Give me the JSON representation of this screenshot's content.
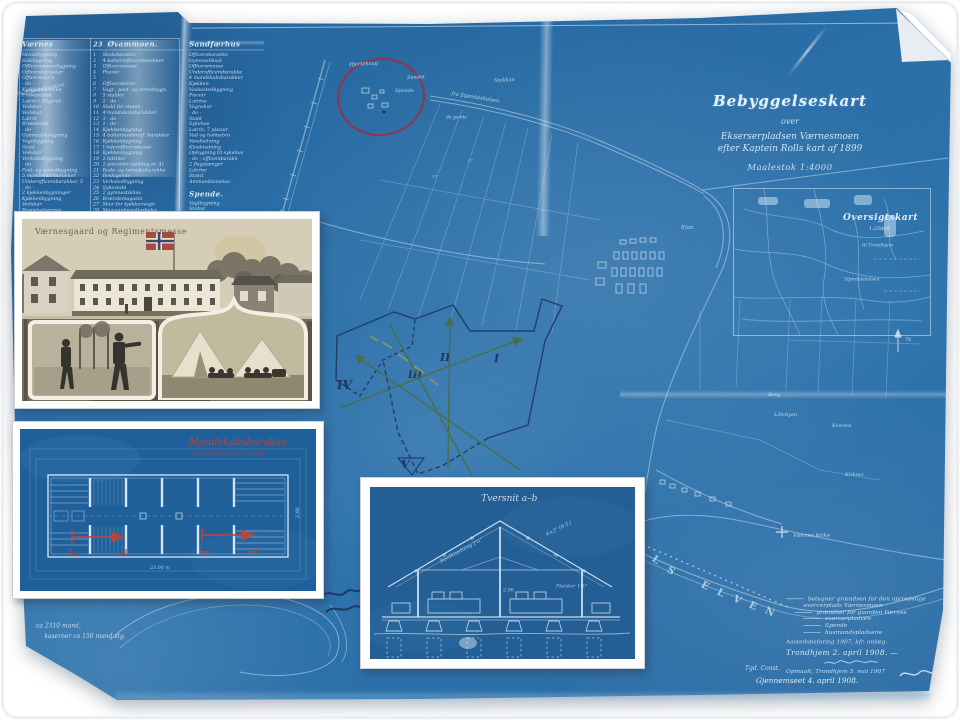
{
  "map": {
    "title_block": {
      "title": "Bebyggelseskart",
      "over": "over",
      "line3": "Ekserserpladsen Værnesmoen",
      "line4": "efter Kaptein Rolls kart af 1899",
      "scale": "Maalestok 1:4000"
    },
    "overview_inset": {
      "title": "Oversigtskart",
      "scale": "1:25000",
      "label1": "til Trondhjem",
      "label2": "Stjørdalshalsen"
    },
    "tables": [
      {
        "header": "Værnes",
        "rows": [
          "Hovedbygning",
          "Sidebygning",
          "Officersmessebygning",
          "Officersbarakker",
          "Officerslatrin",
          "· do ·",
          "Kjøkkenbarakke",
          "Proviantbod",
          "Latrin i Bligeret",
          "Vedskur",
          "Vedskur",
          "Latrin",
          "Brøndstald",
          "· do ·",
          "Gymnastikbygning",
          "Vognbygning",
          "Stald",
          "Vedskur",
          "Verkstedbygning",
          "· do ·",
          "Post- og arrestbygning",
          "5 mandskabsbarakker",
          "Underofficersbarakker, 5",
          "· do ·",
          "2 kjøkkenbygninger",
          "Kjøkkenbygning",
          "Vedskur",
          "Brændselsremis",
          "5 latriner m. 3 piscoir",
          "Vagt- og arrestbygning",
          "12 mandskabsbarakker"
        ]
      },
      {
        "header_num": "23",
        "header": "Øvammoen.",
        "rows": [
          {
            "n": "1",
            "t": "Skolebarakke"
          },
          {
            "n": "2",
            "t": "4 batteriofficersbarakker"
          },
          {
            "n": "3",
            "t": "Officersmesse"
          },
          {
            "n": "4",
            "t": "Piscoir"
          },
          {
            "n": "5",
            "t": "·"
          },
          {
            "n": "6",
            "t": "Officerslatrin"
          },
          {
            "n": "7",
            "t": "Vagt-, post- og arrestbygn."
          },
          {
            "n": "8",
            "t": "5 stalder"
          },
          {
            "n": "9",
            "t": "2 · do ·"
          },
          {
            "n": "10",
            "t": "Stald for staten"
          },
          {
            "n": "11",
            "t": "4 mandskabsbarakker"
          },
          {
            "n": "12",
            "t": "3 · do ·"
          },
          {
            "n": "13",
            "t": "1 · do ·"
          },
          {
            "n": "14",
            "t": "Kjøkkenbygning"
          },
          {
            "n": "15",
            "t": "4 batteriunderoff. barakker"
          },
          {
            "n": "16",
            "t": "Kjøkkenbygning"
          },
          {
            "n": "17",
            "t": "Underofficersmesse"
          },
          {
            "n": "18",
            "t": "Kjøkkenbygning"
          },
          {
            "n": "19",
            "t": "2 latriner"
          },
          {
            "n": "20",
            "t": "2 piscoirer (samlag m. 4)"
          },
          {
            "n": "21",
            "t": "Bade- og tøivaskebarakke"
          },
          {
            "n": "22",
            "t": "Beslagsmie"
          },
          {
            "n": "23",
            "t": "Verkstedbygning"
          },
          {
            "n": "24",
            "t": "Sykestald"
          },
          {
            "n": "25",
            "t": "2 gymnastikhus"
          },
          {
            "n": "26",
            "t": "Brændemagasin"
          },
          {
            "n": "27",
            "t": "Skur for kjøkkenvogn"
          },
          {
            "n": "28",
            "t": "Magasinforvalterbolig"
          },
          {
            "n": "29",
            "t": "Opbygning, arb. magasin"
          },
          {
            "n": "30",
            "t": "· do ·, off. barakker"
          },
          {
            "n": "31",
            "t": "Bindingsverk"
          },
          {
            "n": "32",
            "t": "Ventilation"
          }
        ]
      },
      {
        "header": "Sandfærhus",
        "rows": [
          "Officersbarakke",
          "Gymnastiksal",
          "Officersmesse",
          "Underofficersbarakke",
          "4 mandskabsbarakker",
          "Kjøkken",
          "Vaskestedbygning",
          "Piscoir",
          "Latrine",
          "Vognskur",
          "· do ·",
          "Stald",
          "Sykehus",
          "Latrin, 7 piscoir",
          "Vad og holmebro",
          "Vandledning",
          "Kloakledning",
          "Opbygning til sykehus",
          "· do · officersbarakk",
          "2 flagstænger",
          "Latrine",
          "Stakit",
          "Ammunitionshus"
        ],
        "sub_header": "Spende.",
        "sub_rows": [
          "Vagtbygning",
          "Stabur",
          "Depot",
          "Piscoir",
          "Latrin",
          "Sykestald"
        ]
      }
    ],
    "labels": [
      {
        "t": "fra Stjørdalsstation",
        "x": 16,
        "y": 92,
        "s": 5,
        "r": -12
      },
      {
        "t": "Hjertehaug",
        "x": 349,
        "y": 62,
        "s": 5,
        "r": -3
      },
      {
        "t": "Sandet",
        "x": 407,
        "y": 75,
        "s": 5,
        "r": -2
      },
      {
        "t": "Spende",
        "x": 395,
        "y": 88,
        "s": 5,
        "r": 0
      },
      {
        "t": "de gamle",
        "x": 446,
        "y": 115,
        "s": 4.5,
        "r": 0
      },
      {
        "t": "Stokkan",
        "x": 494,
        "y": 78,
        "s": 5,
        "r": -3
      },
      {
        "t": "fra Stjørdalshalsen",
        "x": 452,
        "y": 91,
        "s": 5,
        "r": 9
      },
      {
        "t": "22",
        "x": 468,
        "y": 158,
        "s": 4,
        "r": 0
      },
      {
        "t": "23",
        "x": 432,
        "y": 174,
        "s": 4,
        "r": 0
      },
      {
        "t": "Eian",
        "x": 681,
        "y": 224,
        "s": 5.5,
        "r": 0
      },
      {
        "t": "Berg",
        "x": 768,
        "y": 392,
        "s": 5,
        "r": 0
      },
      {
        "t": "Lillebyen",
        "x": 774,
        "y": 412,
        "s": 5,
        "r": 0
      },
      {
        "t": "Kvitved",
        "x": 832,
        "y": 423,
        "s": 5,
        "r": 0
      },
      {
        "t": "Kirkmo",
        "x": 845,
        "y": 472,
        "s": 5,
        "r": 0
      },
      {
        "t": "Værnes kirke",
        "x": 793,
        "y": 532,
        "s": 5.5,
        "r": 0
      },
      {
        "t": "7b",
        "x": 905,
        "y": 337,
        "s": 5,
        "r": 0
      }
    ],
    "river_letters": [
      {
        "ch": "A",
        "x": 636,
        "y": 543,
        "r": 35
      },
      {
        "ch": "L",
        "x": 652,
        "y": 555,
        "r": 35
      },
      {
        "ch": "S",
        "x": 667,
        "y": 566,
        "r": 35
      },
      {
        "ch": "E",
        "x": 701,
        "y": 581,
        "r": 28
      },
      {
        "ch": "L",
        "x": 717,
        "y": 588,
        "r": 28
      },
      {
        "ch": "V",
        "x": 733,
        "y": 595,
        "r": 28
      },
      {
        "ch": "E",
        "x": 749,
        "y": 601,
        "r": 25
      },
      {
        "ch": "N",
        "x": 765,
        "y": 607,
        "r": 25
      }
    ],
    "annotations": {
      "romans": [
        "I",
        "II",
        "III",
        "IV",
        "V"
      ]
    },
    "legend": {
      "lines": [
        {
          "t": "betegner grændsen for den oprindelige",
          "s": true,
          "ind": 0
        },
        {
          "t": "exercerplads Værnesmoen",
          "s": false,
          "ind": 2
        },
        {
          "t": "grændser for gaarden Værnes",
          "s": true,
          "ind": 1
        },
        {
          "t": "exercerpladsen",
          "s": true,
          "ind": 2
        },
        {
          "t": "Spende",
          "s": true,
          "ind": 2
        },
        {
          "t": "husmandspladsene",
          "s": true,
          "ind": 2
        }
      ],
      "note1": "Aastedsbefaring 1907, kfr. anlæg.",
      "place_date": "Trondhjem 2. april 1908. —",
      "surveyed": "Opmaalt, Trondhjem 5. mai 1907",
      "clerk": "Tgd. Const.",
      "reviewed": "Gjennemseet 4. april 1908."
    },
    "notes_left": [
      "ca 2310 mand,",
      "kaserner ca 150 mand stg."
    ]
  },
  "insets": {
    "postcard": {
      "caption": "Værnesgaard og Regimentsmesse"
    },
    "floorplan": {
      "title": "Mandskabsbarakke",
      "subtitle": "for 2 peletoner eller 72 mand",
      "dim1": "23.00 m",
      "dim2": "2.96"
    },
    "section": {
      "title": "Tversnit a–b",
      "annotations": [
        "4×3\" (B.T.)",
        "Bordklædning 1¼\"",
        "2.96",
        "Planker 1½\""
      ]
    }
  },
  "colors": {
    "blueprint": "#2a6ca6",
    "ink_navy": "#1e3560",
    "annotation_green": "#4d6c38",
    "annotation_red": "#9a3040",
    "floorplan_red": "#b5443c",
    "postcard_sepia": "#d6cdb6"
  }
}
